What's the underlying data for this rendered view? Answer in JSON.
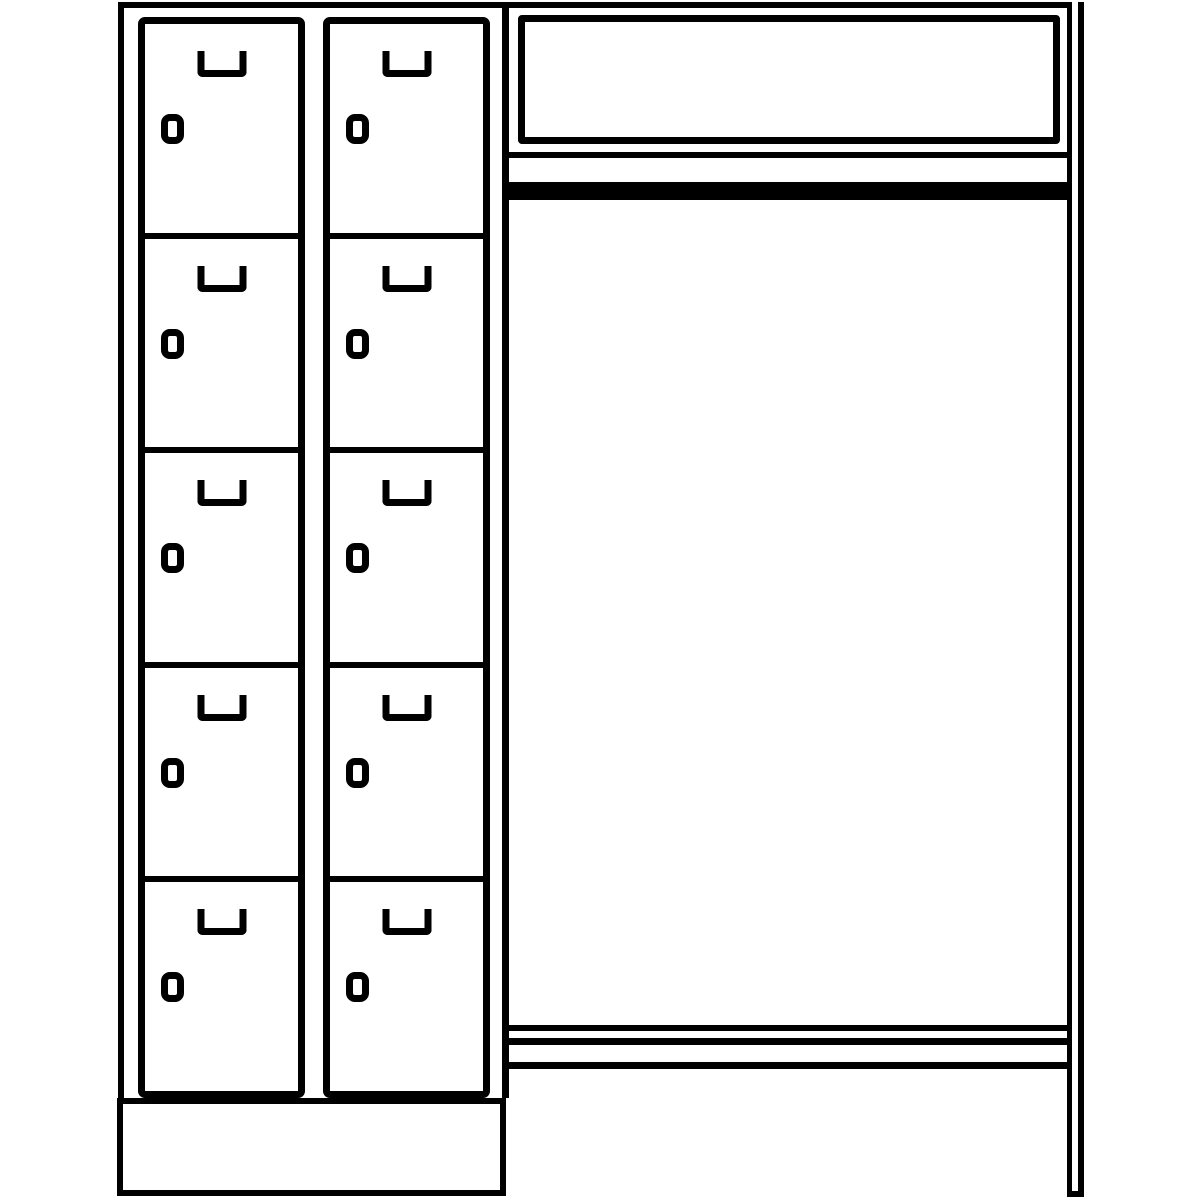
{
  "drawing": {
    "type": "technical-line-drawing",
    "subject": "cloakroom locker combination, front elevation",
    "colors": {
      "line": "#000000",
      "background": "#ffffff"
    }
  },
  "locker_block": {
    "columns": 2,
    "compartments_per_column": 5,
    "total_compartments": 10,
    "door_features": [
      "u-shaped-handle",
      "cylinder-lock"
    ],
    "base": "plinth"
  },
  "cloakroom_section": {
    "components": [
      "hat-shelf",
      "shelf-bottom-rail",
      "coat-rail",
      "bench-rails",
      "right-side-frame"
    ],
    "bench_rail_count": 3,
    "coat_rail_fill": "#000000"
  }
}
